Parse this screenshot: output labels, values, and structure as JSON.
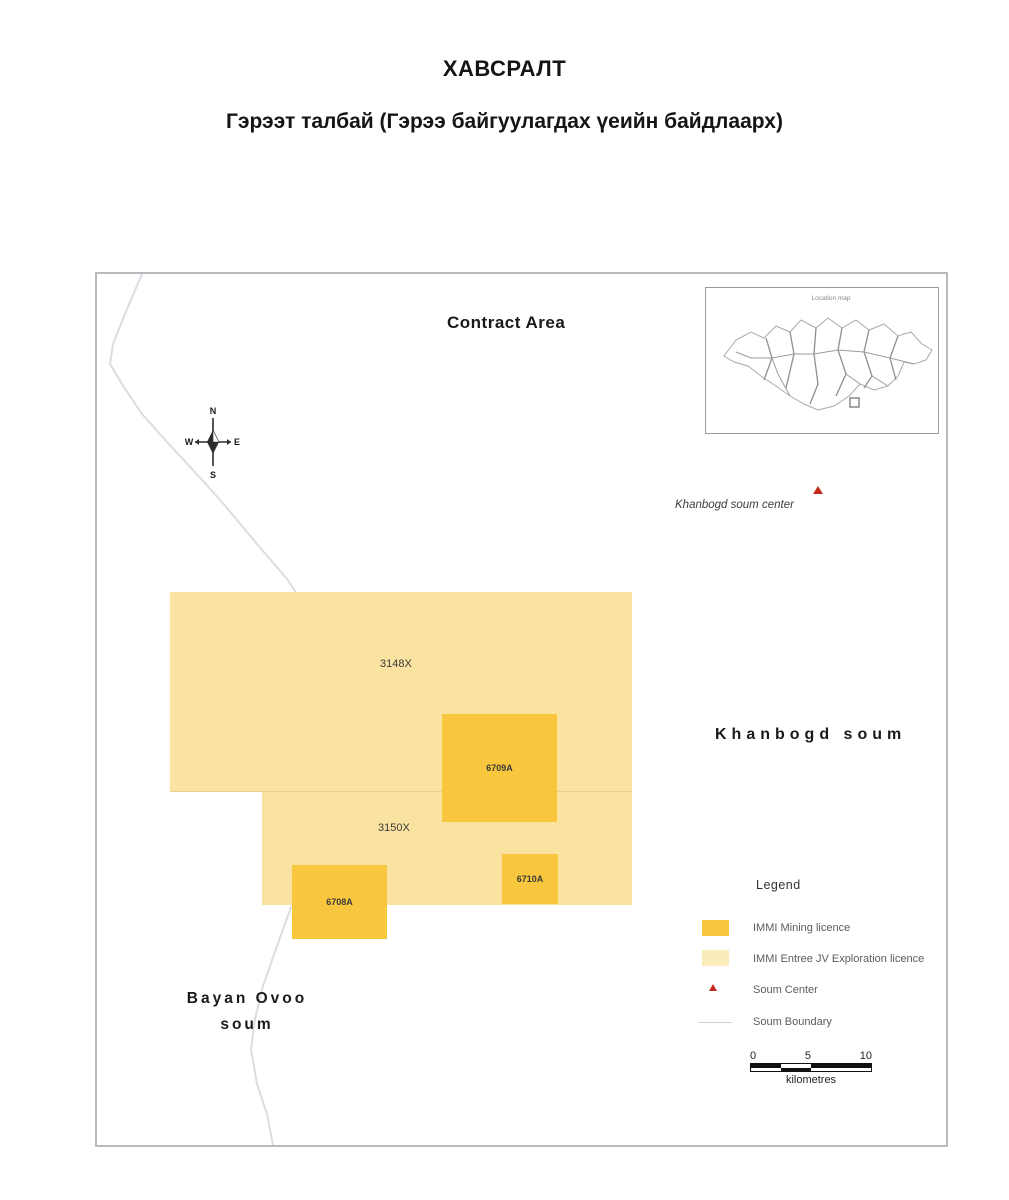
{
  "page": {
    "title": "ХАВСРАЛТ",
    "subtitle": "Гэрээт талбай (Гэрээ байгуулагдах үеийн байдлаарх)"
  },
  "map": {
    "title": "Contract Area",
    "inset_title": "Location map",
    "compass": {
      "n": "N",
      "e": "E",
      "s": "S",
      "w": "W"
    },
    "soum_center_label": "Khanbogd soum center",
    "khanbogd_label": "Khanbogd soum",
    "bayan_ovoo_line1": "Bayan Ovoo",
    "bayan_ovoo_line2": "soum",
    "licences": {
      "exploration": [
        {
          "id": "3148X"
        },
        {
          "id": "3150X"
        }
      ],
      "mining": [
        {
          "id": "6709A"
        },
        {
          "id": "6710A"
        },
        {
          "id": "6708A"
        }
      ]
    }
  },
  "legend": {
    "title": "Legend",
    "items": [
      {
        "label": "IMMI Mining licence"
      },
      {
        "label": "IMMI Entree JV Exploration licence"
      },
      {
        "label": "Soum Center"
      },
      {
        "label": "Soum Boundary"
      }
    ]
  },
  "scalebar": {
    "ticks": [
      "0",
      "5",
      "10"
    ],
    "unit": "kilometres"
  },
  "colors": {
    "mining": "#F8C73E",
    "exploration": "#FAE3A0",
    "exploration_legend": "#FBECBC",
    "soum_center": "#C2281E",
    "boundary_line": "#DCDCE2"
  }
}
